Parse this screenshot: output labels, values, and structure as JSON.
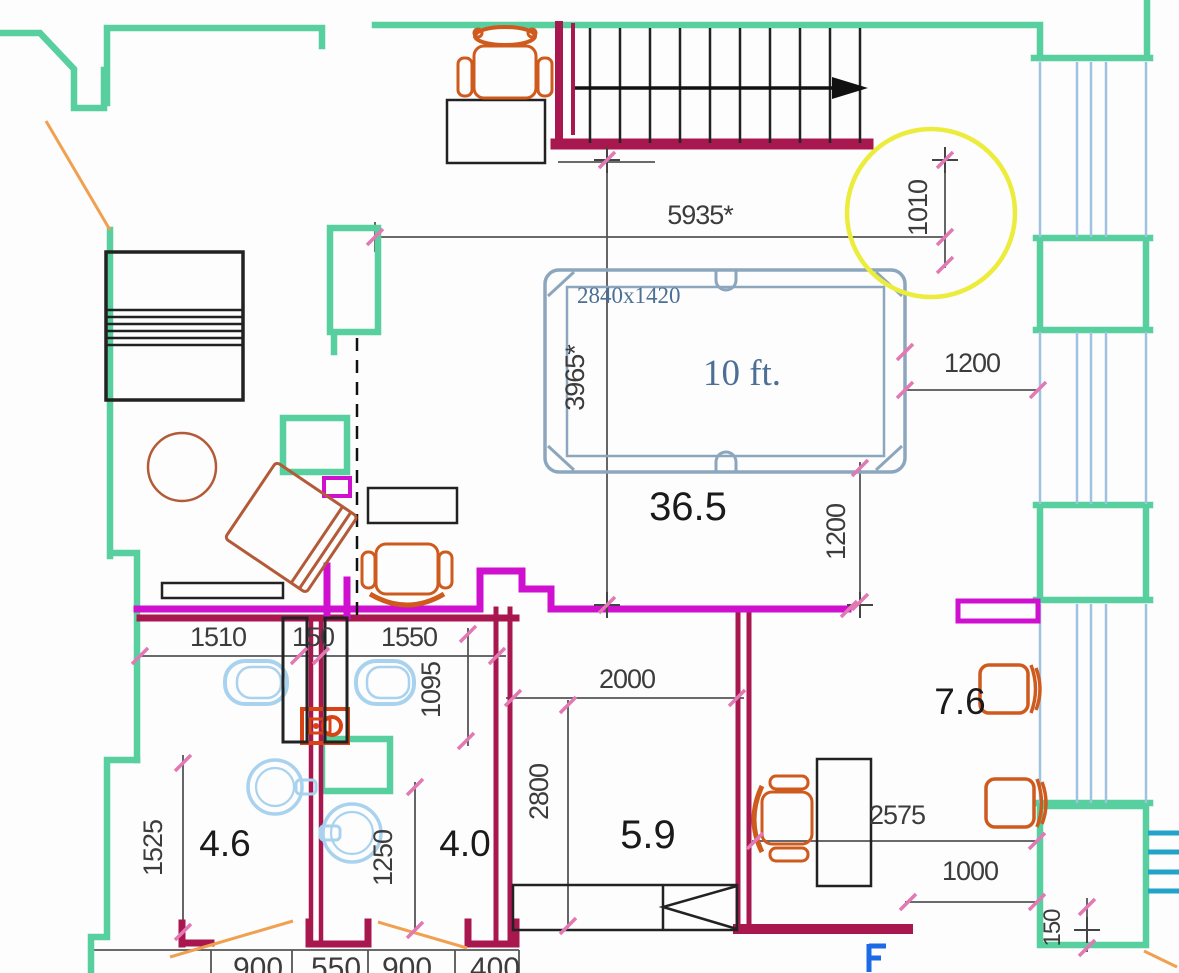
{
  "drawing": {
    "kind": "apartment floor plan",
    "units": "mm"
  },
  "colors": {
    "wall_existing_green": "#57cf9e",
    "wall_new_magenta": "#cf10cf",
    "wall_new_crimson": "#a8174e",
    "furniture_orange": "#cf5a1e",
    "armchair_brown": "#b35b38",
    "fixture_light_blue": "#a9d2ee",
    "pool_table_blue": "#8ba6bd",
    "pool_table_text": "#4c6f96",
    "highlight_yellow": "#ecec3c",
    "balcony_teal": "#23a3c9",
    "electric_blue": "#1b6ce4",
    "door_swing_orange": "#efa050",
    "dim_text": "#3c3c3c",
    "tick_pink": "#e279b4"
  },
  "rooms": {
    "hall": {
      "area": "36.5"
    },
    "middle": {
      "area": "5.9"
    },
    "bath_left": {
      "area": "4.6"
    },
    "bath_right": {
      "area": "4.0"
    },
    "office": {
      "area": "7.6"
    }
  },
  "pool_table": {
    "size": "2840x1420",
    "label": "10 ft."
  },
  "dims": {
    "hall_width": "5935*",
    "stair_gap": "1010",
    "hall_height": "3965*",
    "table_right_gap": "1200",
    "table_bottom_gap": "1200",
    "wc_left": "1510",
    "wc_wall": "150",
    "wc_right": "1550",
    "wc_depth": "1095",
    "mid_width": "2000",
    "mid_height": "2800",
    "left_height": "1525",
    "bath_height": "1250",
    "office_width": "2575",
    "office_door": "1000",
    "corner": "150",
    "bottom_row": [
      "900",
      "550",
      "900",
      "400"
    ]
  }
}
